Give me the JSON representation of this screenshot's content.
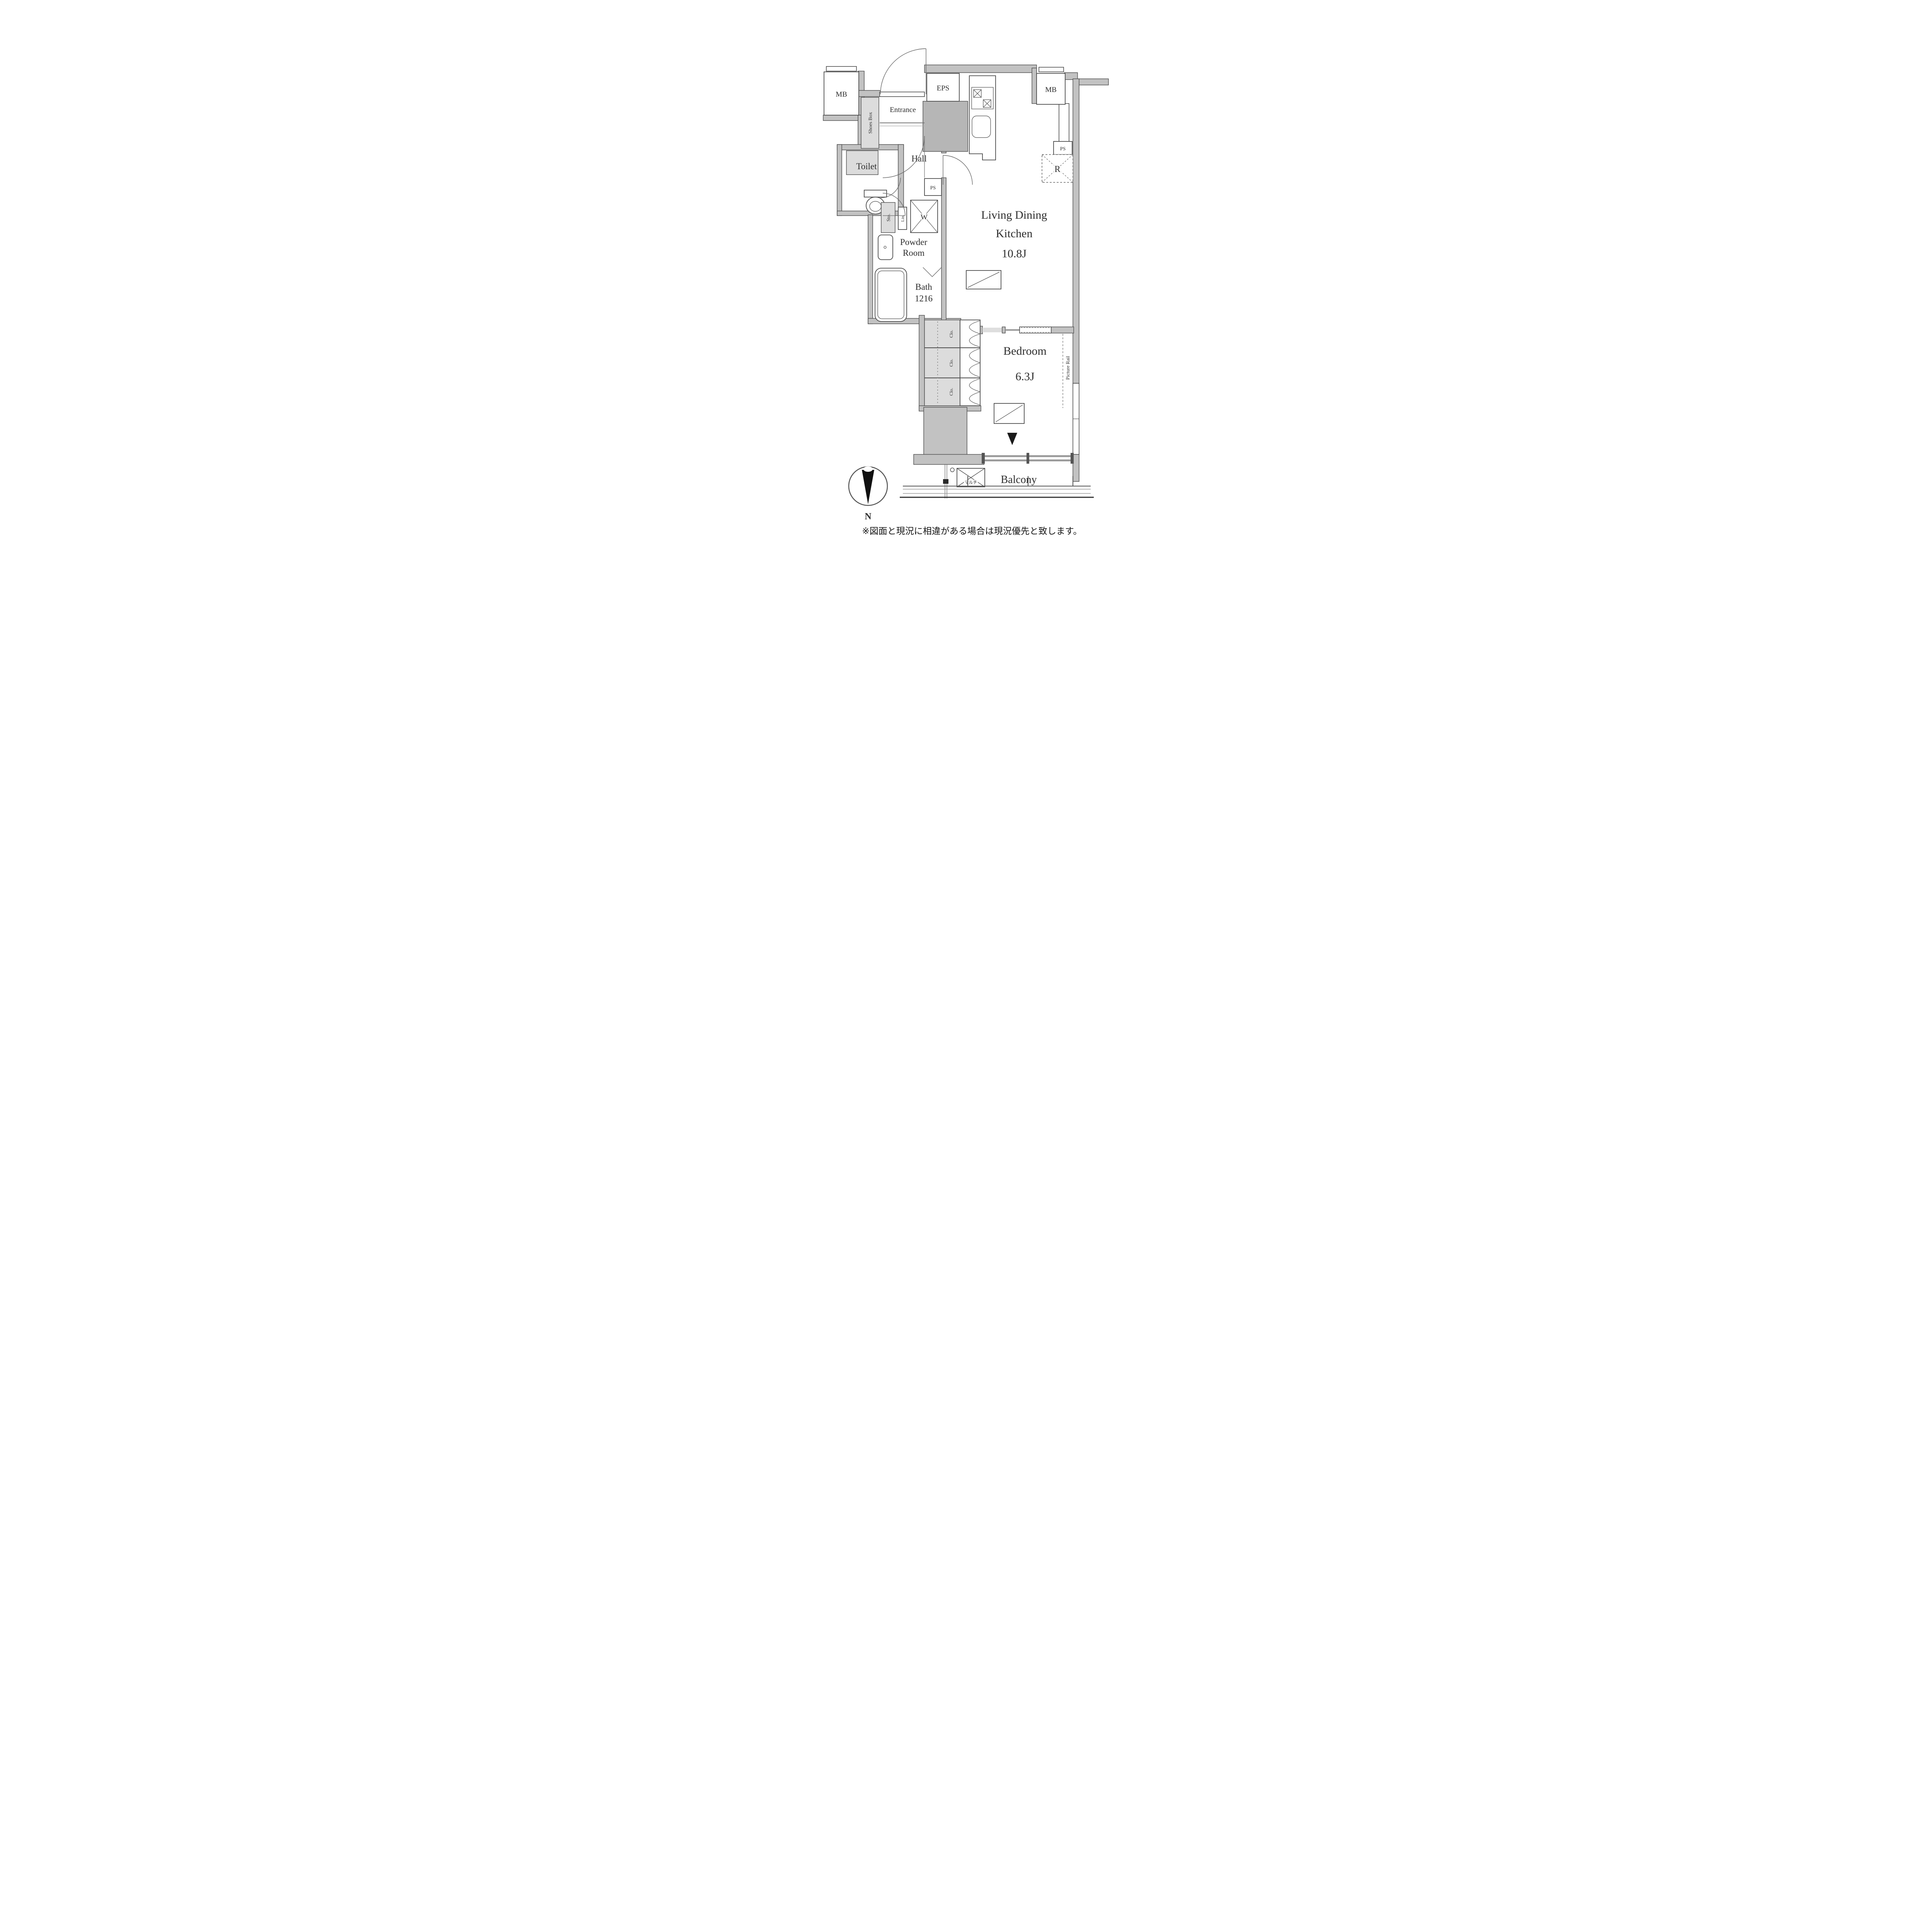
{
  "floor_plan": {
    "rooms": {
      "ldk": {
        "line1": "Living Dining",
        "line2": "Kitchen",
        "size": "10.8J"
      },
      "bedroom": {
        "name": "Bedroom",
        "size": "6.3J"
      },
      "bath": {
        "name": "Bath",
        "size": "1216"
      },
      "powder_room": {
        "line1": "Powder",
        "line2": "Room"
      },
      "toilet": {
        "name": "Toilet"
      },
      "hall": {
        "name": "Hall"
      },
      "entrance": {
        "name": "Entrance"
      },
      "balcony": {
        "name": "Balcony"
      }
    },
    "fixtures": {
      "shoes_box": "Shoes Box",
      "mb_left": "MB",
      "mb_right": "MB",
      "eps": "EPS",
      "ps_right": "PS",
      "ps_hall": "PS",
      "refrigerator": "R",
      "washer": "W",
      "storage": "Sto.",
      "linen": "Lin.",
      "closets": [
        "Clo.",
        "Clo.",
        "Clo."
      ],
      "picture_rail": "Picture Rail",
      "multi_outlet": "マルチ"
    },
    "compass": {
      "north": "N"
    },
    "disclaimer": "※図面と現況に相違がある場合は現況優先と致します。",
    "colors": {
      "wall": "#c2c2c2",
      "wall_dark": "#b2b2b2",
      "shaft": "#b6b6b6",
      "light_fill": "#dcdcdc",
      "line": "#4d4d4d",
      "text": "#2e2e2e",
      "background": "#ffffff"
    }
  }
}
